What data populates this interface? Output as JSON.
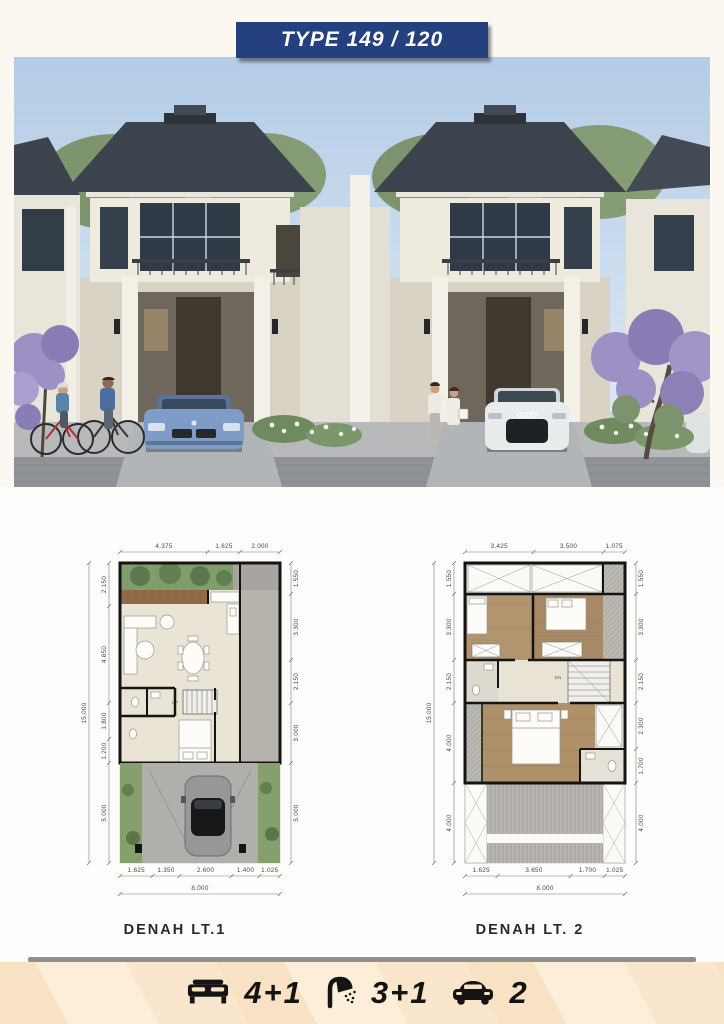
{
  "banner": {
    "title": "TYPE 149 / 120"
  },
  "plans": {
    "p1": {
      "caption": "DENAH LT.1",
      "top": [
        "4.375",
        "1.625",
        "2.000"
      ],
      "left": [
        "2.150",
        "4.850",
        "1.800",
        "1.200",
        "5.000"
      ],
      "left_total": "15.000",
      "right": [
        "1.550",
        "3.300",
        "2.150",
        "3.000",
        "5.000"
      ],
      "bottom": [
        "1.625",
        "1.350",
        "2.600",
        "1.400",
        "1.025"
      ],
      "bottom_total": "8.000",
      "stairs": "UP"
    },
    "p2": {
      "caption": "DENAH LT. 2",
      "top": [
        "3.425",
        "3.500",
        "1.075"
      ],
      "left": [
        "1.550",
        "3.300",
        "2.150",
        "4.000",
        "4.000"
      ],
      "left_total": "15.000",
      "right": [
        "1.550",
        "3.300",
        "2.150",
        "2.300",
        "1.700",
        "4.000"
      ],
      "bottom": [
        "1.625",
        "3.650",
        "1.700",
        "1.025"
      ],
      "bottom_total": "8.000",
      "stairs": "DN"
    }
  },
  "footer": {
    "bedrooms": "4+1",
    "bathrooms": "3+1",
    "carports": "2"
  },
  "colors": {
    "banner_navy": "#24407e",
    "cream_strip": "#fbe7cb",
    "roof": "#3d434c",
    "sky": "#bcd1e7",
    "lawn": "#86a06d",
    "wood_deck": "#8f6c47",
    "plan_floor": "#eae4d6",
    "wood_floor": "#b2946f"
  }
}
